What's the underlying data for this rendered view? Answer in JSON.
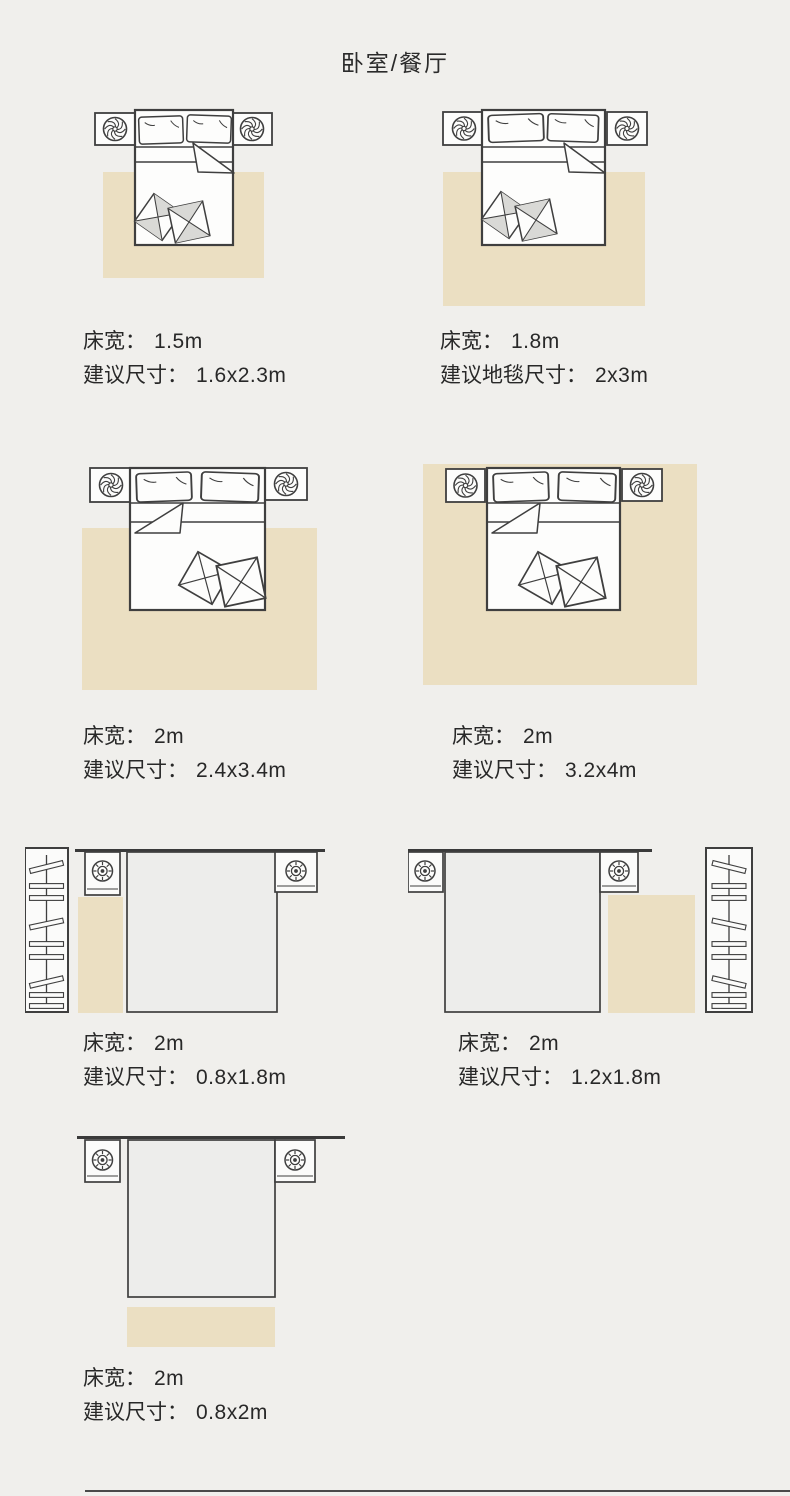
{
  "title": "卧室/餐厅",
  "colors": {
    "background": "#f0efec",
    "rug": "#ebdfc2",
    "line": "#3f3f3f",
    "text": "#282828"
  },
  "figures": [
    {
      "name": "bed-1.5m-rug-side",
      "width_label": "床宽：",
      "width_value": "1.5m",
      "size_label": "建议尺寸：",
      "size_value": "1.6x2.3m"
    },
    {
      "name": "bed-1.8m-rug-side",
      "width_label": "床宽：",
      "width_value": "1.8m",
      "size_label": "建议地毯尺寸：",
      "size_value": "2x3m"
    },
    {
      "name": "bed-2m-rug-large",
      "width_label": "床宽：",
      "width_value": "2m",
      "size_label": "建议尺寸：",
      "size_value": "2.4x3.4m"
    },
    {
      "name": "bed-2m-rug-full",
      "width_label": "床宽：",
      "width_value": "2m",
      "size_label": "建议尺寸：",
      "size_value": "3.2x4m"
    },
    {
      "name": "bed-2m-runner-left",
      "width_label": "床宽：",
      "width_value": "2m",
      "size_label": "建议尺寸：",
      "size_value": "0.8x1.8m"
    },
    {
      "name": "bed-2m-runner-right",
      "width_label": "床宽：",
      "width_value": "2m",
      "size_label": "建议尺寸：",
      "size_value": "1.2x1.8m"
    },
    {
      "name": "bed-2m-runner-foot",
      "width_label": "床宽：",
      "width_value": "2m",
      "size_label": "建议尺寸：",
      "size_value": "0.8x2m"
    }
  ]
}
